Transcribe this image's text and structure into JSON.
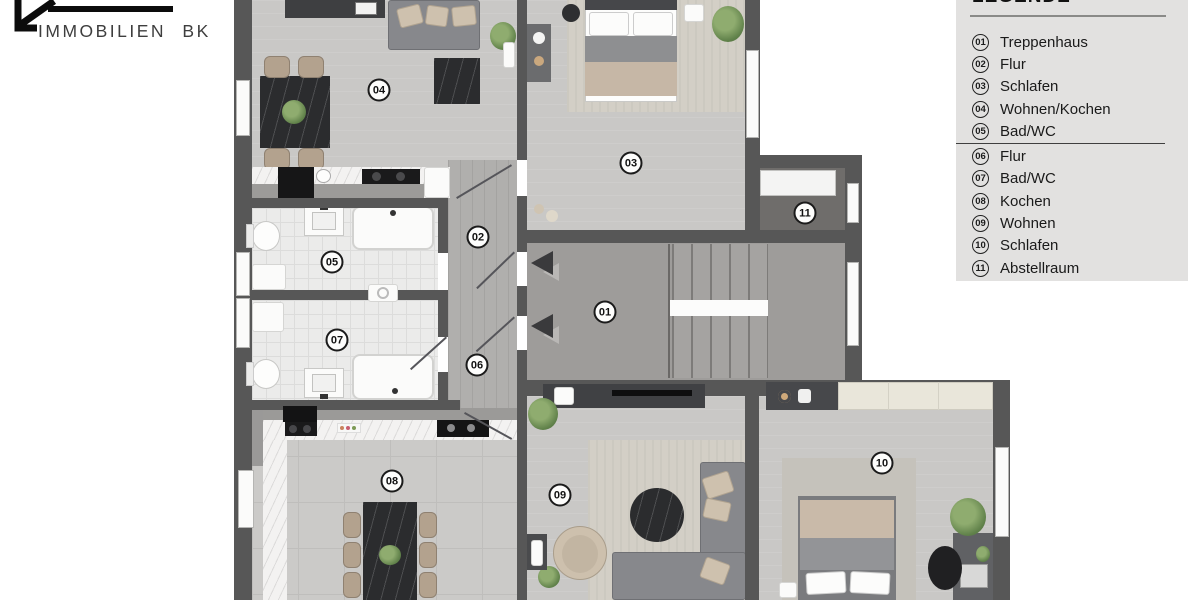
{
  "logo": {
    "text": "IMMOBILIEN BK"
  },
  "legend": {
    "title": "LEGENDE",
    "divider_after_num": "05",
    "items": [
      {
        "num": "01",
        "label": "Treppenhaus"
      },
      {
        "num": "02",
        "label": "Flur"
      },
      {
        "num": "03",
        "label": "Schlafen"
      },
      {
        "num": "04",
        "label": "Wohnen/Kochen"
      },
      {
        "num": "05",
        "label": "Bad/WC"
      },
      {
        "num": "06",
        "label": "Flur"
      },
      {
        "num": "07",
        "label": "Bad/WC"
      },
      {
        "num": "08",
        "label": "Kochen"
      },
      {
        "num": "09",
        "label": "Wohnen"
      },
      {
        "num": "10",
        "label": "Schlafen"
      },
      {
        "num": "11",
        "label": "Abstellraum"
      }
    ]
  },
  "plan": {
    "room_labels": [
      {
        "num": "04",
        "x": 379,
        "y": 90
      },
      {
        "num": "03",
        "x": 631,
        "y": 163
      },
      {
        "num": "11",
        "x": 805,
        "y": 213
      },
      {
        "num": "02",
        "x": 478,
        "y": 237
      },
      {
        "num": "05",
        "x": 332,
        "y": 262
      },
      {
        "num": "01",
        "x": 605,
        "y": 312
      },
      {
        "num": "07",
        "x": 337,
        "y": 340
      },
      {
        "num": "06",
        "x": 477,
        "y": 365
      },
      {
        "num": "10",
        "x": 882,
        "y": 463
      },
      {
        "num": "08",
        "x": 392,
        "y": 481
      },
      {
        "num": "09",
        "x": 560,
        "y": 495
      }
    ]
  },
  "icons": {
    "entrance_arrow": "◄",
    "house_logo": "house-roof outline"
  },
  "colors": {
    "wall": "#575757",
    "legend_bg": "#e2e1e0",
    "floor_wood": "#c9c8c6",
    "floor_corridor": "#b0afad",
    "floor_stairwell": "#9e9c9a",
    "floor_storage": "#6f6d6b",
    "bath_tile": "#ebebea",
    "furniture_dark": "#2b2c2e",
    "chair_beige": "#b3a28e",
    "ink": "#1a1a1a"
  }
}
